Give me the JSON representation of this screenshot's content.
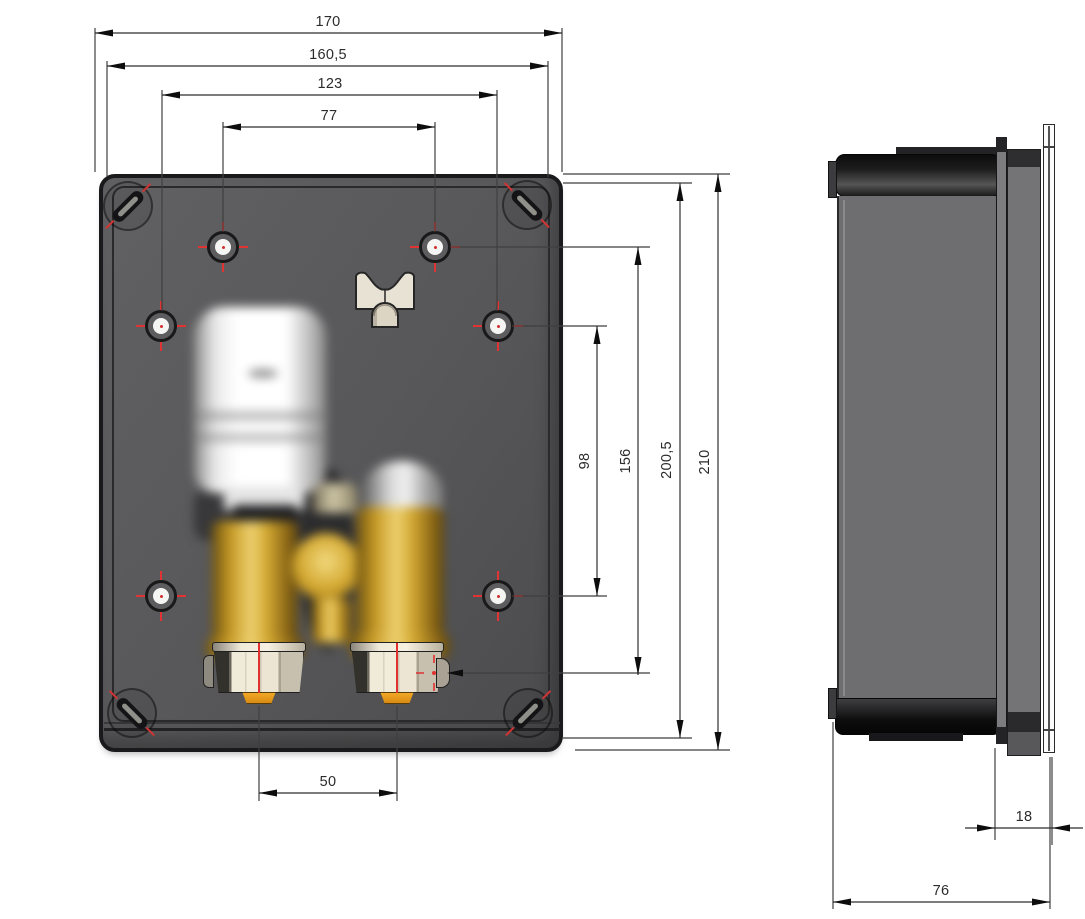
{
  "front_view": {
    "dimensions": {
      "outer_width": "170",
      "inner_width": "160,5",
      "hole_span_wide": "123",
      "hole_span_narrow": "77",
      "hole_span_vertical_inner": "98",
      "hole_span_vertical_outer": "156",
      "inner_height": "200,5",
      "outer_height": "210",
      "pipe_spacing": "50"
    }
  },
  "side_view": {
    "dimensions": {
      "front_depth": "18",
      "total_depth": "76"
    }
  },
  "colors": {
    "box_face": "#58585a",
    "box_edge": "#1a1a1c",
    "rim_line": "#2a2a2c",
    "brass": "#c9992b",
    "orange_insert": "#e8991d",
    "marker_red": "#e03030",
    "clamp_beige": "#d9d2c1",
    "thermostat_white": "#ffffff",
    "dimension_line": "#3f3f3f",
    "background": "#ffffff"
  }
}
